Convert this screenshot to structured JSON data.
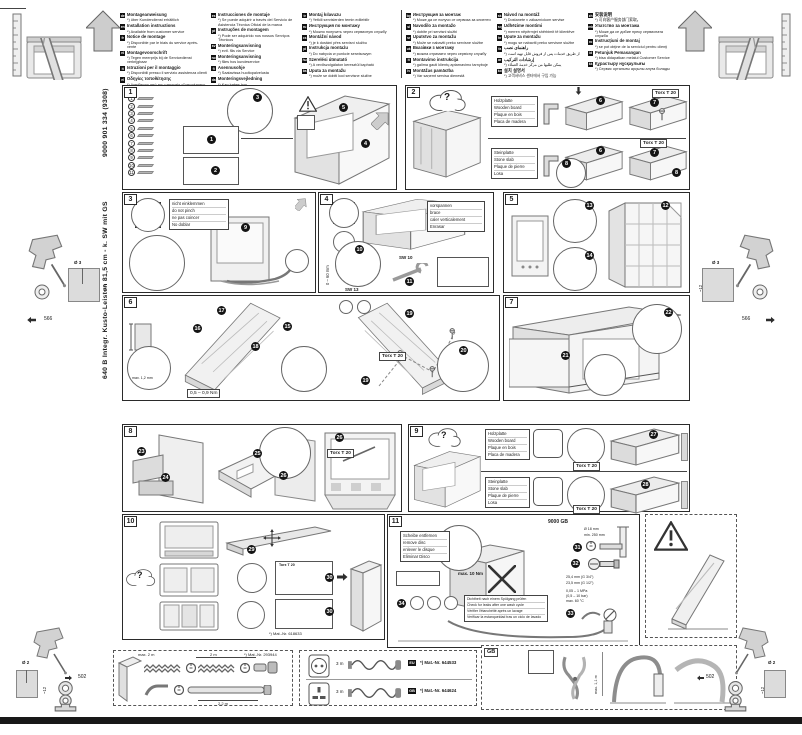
{
  "page": {
    "bg": "#ffffff",
    "bar_color": "#181818",
    "accent_black": "#141414",
    "line_gray": "#777777",
    "fill_gray": "#e6e6e6"
  },
  "sidebar": {
    "model": "640 B Integr. Kusto-Leisten 81,5 cm - k. SW mit GS",
    "doc_no": "9000 901 334 (9308)"
  },
  "header": {
    "columns": [
      [
        {
          "code": "de",
          "title": "Montageanweisung",
          "note": "*) über Kundendienst erhältlich"
        },
        {
          "code": "en",
          "title": "Installation instructions",
          "note": "*) Available from customer service"
        },
        {
          "code": "fr",
          "title": "Notice de montage",
          "note": "*) Disponible par le biais du service après-vente"
        },
        {
          "code": "nl",
          "title": "Montagevoorschrift",
          "note": "*) Tegen meerprijs bij de Servicedienst verkrijgbaar"
        },
        {
          "code": "it",
          "title": "Istruzioni per il montaggio",
          "note": "*) Disponibili presso il servizio assistenza clienti"
        },
        {
          "code": "el",
          "title": "Οδηγίες τοποθέτησης",
          "note": "*) Διατίθενται από την υπηρεσία εξυπηρέτησης πελατών"
        }
      ],
      [
        {
          "code": "es",
          "title": "Instrucciones de montaje",
          "note": "*) Se puede adquirir a través del Servicio de Asistencia Técnica Oficial de la marca"
        },
        {
          "code": "pt",
          "title": "Instruções de montagem",
          "note": "*) Pode ser adquirido nos nossos Serviços Técnicos"
        },
        {
          "code": "sv",
          "title": "Monteringsanvisning",
          "note": "*) evtl. fås via Service"
        },
        {
          "code": "no",
          "title": "Monteringsanvisning",
          "note": "*) fåes hos kundeservice"
        },
        {
          "code": "fi",
          "title": "Asennusohje",
          "note": "*) Saatavissa huoltopalvelusta"
        },
        {
          "code": "da",
          "title": "Monteringsvejledning",
          "note": "*) Kan købes hos servicefirmaet/serviceafdelingen"
        }
      ],
      [
        {
          "code": "tr",
          "title": "Montaj kılavuzu",
          "note": "*) Yetkili servislerden temin edilebilir"
        },
        {
          "code": "ru",
          "title": "Инструкция по монтажу",
          "note": "*) Можно получить через сервисную службу"
        },
        {
          "code": "cs",
          "title": "Montážní návod",
          "note": "*) je k dostání přes servisní službu"
        },
        {
          "code": "pl",
          "title": "Instrukcja montażu",
          "note": "*) Do nabycia w punkcie serwisowym"
        },
        {
          "code": "hu",
          "title": "Szerelési útmutató",
          "note": "*) A vevőszolgálaton keresztül kapható"
        },
        {
          "code": "bs",
          "title": "Uputa za montažu",
          "note": "*) može se dobiti kod servisne službe"
        }
      ],
      [
        {
          "code": "bg",
          "title": "Инструкция за монтаж",
          "note": "*) Може да се получи от сервиза за клиенти"
        },
        {
          "code": "sl",
          "title": "Navodilo za montažo",
          "note": "*) dobite pri servisni službi"
        },
        {
          "code": "sr",
          "title": "Uputstvo za montažu",
          "note": "*) Može se nabaviti preko servisne službe"
        },
        {
          "code": "uk",
          "title": "Вказівки з монтажу",
          "note": "*) можна отримати через сервісну службу"
        },
        {
          "code": "lt",
          "title": "Montavimo instrukcija",
          "note": "*) galima gauti klientų aptarnavimo tarnyboje"
        },
        {
          "code": "lv",
          "title": "Montāžas pamācība",
          "note": "*) Var saņemt servisa dienestā"
        }
      ],
      [
        {
          "code": "sk",
          "title": "Návod na montáž",
          "note": "*) Dostanete v zákazníckom servise"
        },
        {
          "code": "sq",
          "title": "Udhëzime montimi",
          "note": "*) merren nëpërmjet shërbimit të klientëve"
        },
        {
          "code": "hr",
          "title": "Upute za montažu",
          "note": "*) mogu se nabaviti preko servisne službe"
        },
        {
          "code": "fa",
          "title": "راهنمای نصب",
          "note": "*) از طریق خدمات پس از فروش قابل تهیه است"
        },
        {
          "code": "ar",
          "title": "إرشادات التركيب",
          "note": "*) يمكن طلبها من مركز خدمة العملاء"
        },
        {
          "code": "ko",
          "title": "설치 설명서",
          "note": "*) 고객서비스 센터에서 구입 가능"
        }
      ],
      [
        {
          "code": "zh",
          "title": "安装说明",
          "note": "*) 可向客户服务部门索取。"
        },
        {
          "code": "mk",
          "title": "Упатство за монтажа",
          "note": "*) Може да се добие преку сервисната служба"
        },
        {
          "code": "ro",
          "title": "Instrucţiuni de montaj",
          "note": "*) se pot obţine de la serviciul pentru clienţi"
        },
        {
          "code": "id",
          "title": "Petunjuk Pemasangan",
          "note": "*) bisa didapatkan melalui Customer Service"
        },
        {
          "code": "kk",
          "title": "Құрастыру нұсқаулығы",
          "note": "*) Сервис орталығы арқылы алуға болады"
        }
      ]
    ]
  },
  "margins": {
    "hole_top_dia": "Ø 3",
    "hole_top_depth": "~12",
    "hole_top_offset": "566",
    "hole_bottom_dia": "Ø 2",
    "hole_bottom_depth": "~12",
    "hole_bottom_offset": "502"
  },
  "steps": {
    "s1": {
      "num": "1",
      "parts": [
        "1",
        "2",
        "3",
        "4",
        "5",
        "6",
        "7",
        "8",
        "9",
        "10",
        "11"
      ],
      "badges": [
        "1",
        "2",
        "3",
        "4",
        "5"
      ]
    },
    "s2": {
      "num": "2",
      "question": "?",
      "wood": [
        "Holzplatte",
        "Wooden board",
        "Plaque en bois",
        "Placa de madera"
      ],
      "stone": [
        "Steinplatte",
        "Stone slab",
        "Plaque de pierre",
        "Losa"
      ],
      "torx": "Torx T 20",
      "badges": [
        "6",
        "7",
        "8"
      ]
    },
    "s3": {
      "num": "3",
      "note": [
        "nicht einklemmen",
        "do not pinch",
        "ne pas coincer",
        "No doblar"
      ],
      "badge": "9"
    },
    "s4": {
      "num": "4",
      "note": [
        "vorspannen",
        "brace",
        "caler verticalement",
        "Enrasar"
      ],
      "badges": [
        "10",
        "11"
      ],
      "wrench_front": "SW 13",
      "wrench_rear": "SW 10",
      "adjust_range": "0 – 60 mm"
    },
    "s5": {
      "num": "5",
      "badges": [
        "12",
        "13",
        "14"
      ]
    },
    "s6": {
      "num": "6",
      "badges": [
        "15",
        "16",
        "17",
        "18",
        "19",
        "20"
      ],
      "torx": "Torx T 20",
      "edge_gap": "max. 1,2 mm",
      "torque": "0,5 – 0,9 Nm"
    },
    "s7": {
      "num": "7",
      "badges": [
        "21",
        "22"
      ]
    },
    "s8": {
      "num": "8",
      "badges": [
        "23",
        "24",
        "25",
        "26"
      ],
      "torx": "Torx T 20"
    },
    "s9": {
      "num": "9",
      "question": "?",
      "wood": [
        "Holzplatte",
        "Wooden board",
        "Plaque en bois",
        "Placa de madera"
      ],
      "stone": [
        "Steinplatte",
        "Stone slab",
        "Plaque de pierre",
        "Losa"
      ],
      "badges": [
        "27",
        "28"
      ],
      "torx": "Torx T 20"
    },
    "s10": {
      "num": "10",
      "question": "?",
      "badges": [
        "29",
        "30"
      ],
      "torx": "Torx T 20",
      "mat_nr": "*) Mat.-Nr. 618633"
    },
    "s11": {
      "num": "11",
      "disc_note": [
        "Scheibe entfernen",
        "remove disc",
        "enlever le disque",
        "Eliminar Disco"
      ],
      "badges": [
        "31",
        "32",
        "33",
        "34"
      ],
      "leak_note": [
        "Dichtheit nach einem Spülgang prüfen",
        "Check for leaks after one wash cycle",
        "Vérifier l'étanchéité après un lavage",
        "Verificar la estanqueidad tras un ciclo de lavado"
      ],
      "torque": "max. 10 Nm",
      "ref": "9000 GB",
      "hose_dia": "Ø 18 mm",
      "min_height": "min. 250 mm",
      "thread_a": "25,4 mm (G 3/4\")",
      "thread_b": "23,5 mm (G 1/2\")",
      "pressure": "0,05 – 1 MPa",
      "pressure_bar": "(0,5 – 10 bar)",
      "temp": "max. 60 °C"
    }
  },
  "accessories": {
    "hose_kit": {
      "limit": "max. 2 m",
      "len_a": "2 m",
      "len_b": "2,2 m",
      "mat_nr": "*) Mat.-Nr. 293944"
    },
    "cords": {
      "eu_label": "EU",
      "eu_mat": "*) Mat.-Nr. 644533",
      "gb_label": "GB",
      "gb_mat": "*) Mat.-Nr. 644624",
      "len_a": "3 m",
      "len_b": "3 m"
    },
    "gb_panel": {
      "label": "GB",
      "max_len": "max. 1,1 m"
    }
  }
}
